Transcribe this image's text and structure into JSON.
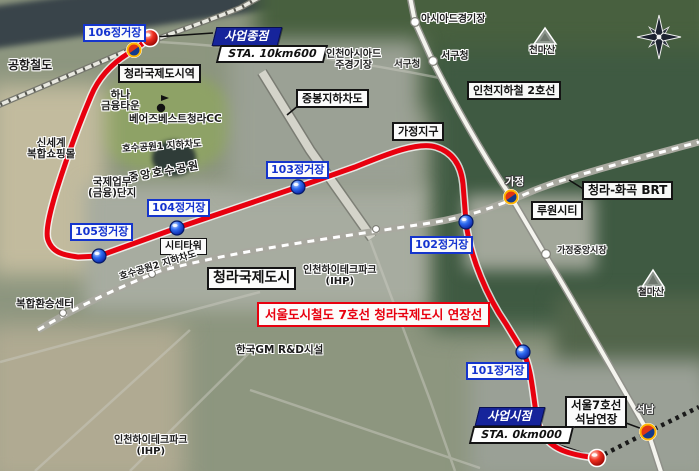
{
  "colors": {
    "line7_red": "#e8000f",
    "station_blue": "#1535cc",
    "flag_blue": "#16249b"
  },
  "line7": {
    "banner": "서울도시철도 7호선 청라국제도시 연장선",
    "stations": [
      {
        "label": "101정거장"
      },
      {
        "label": "102정거장"
      },
      {
        "label": "103정거장"
      },
      {
        "label": "104정거장"
      },
      {
        "label": "105정거장"
      },
      {
        "label": "106정거장"
      }
    ],
    "terminus_station": "청라국제도시역",
    "seoknam_ext_l1": "서울7호선",
    "seoknam_ext_l2": "석남연장"
  },
  "project": {
    "end_title": "사업종점",
    "end_sta": "STA. 10km600",
    "start_title": "사업시점",
    "start_sta": "STA. 0km000"
  },
  "other_lines": {
    "airport_rail": "공항철도",
    "incheon_subway2": "인천지하철 2호선",
    "brt": "청라-화곡 BRT"
  },
  "incheon2_stations": {
    "asiad_stadium": "아시아드경기장",
    "seogucheong": "서구청",
    "gajeong": "가정",
    "gajeong_market": "가정중앙시장",
    "seoknam": "석남"
  },
  "places": {
    "asiad_main_stadium_l1": "인천아시아드",
    "asiad_main_stadium_l2": "주경기장",
    "seogucheong_map": "서구청",
    "hana_l1": "하나",
    "hana_l2": "금융타운",
    "bears_best": "베어즈베스트청라CC",
    "shinsegae_l1": "신세계",
    "shinsegae_l2": "복합쇼핑몰",
    "lake_underpass1": "호수공원1 지하차도",
    "central_lake_park": "중앙호수공원",
    "ibd_l1": "국제업무",
    "ibd_l2": "(금융)단지",
    "city_tower": "시티타워",
    "cheongna_city": "청라국제도시",
    "jungbong_underpass": "중봉지하차도",
    "gajeong_district": "가정지구",
    "lu1_city": "루원시티",
    "lake_underpass2": "호수공원2 지하차도",
    "transfer_center": "복합환승센터",
    "ihp_l1": "인천하이테크파크",
    "ihp_l2": "(IHP)",
    "gm_rnd": "한국GM R&D시설",
    "mt_cheonma": "천마산",
    "mt_cheolma": "철마산"
  }
}
